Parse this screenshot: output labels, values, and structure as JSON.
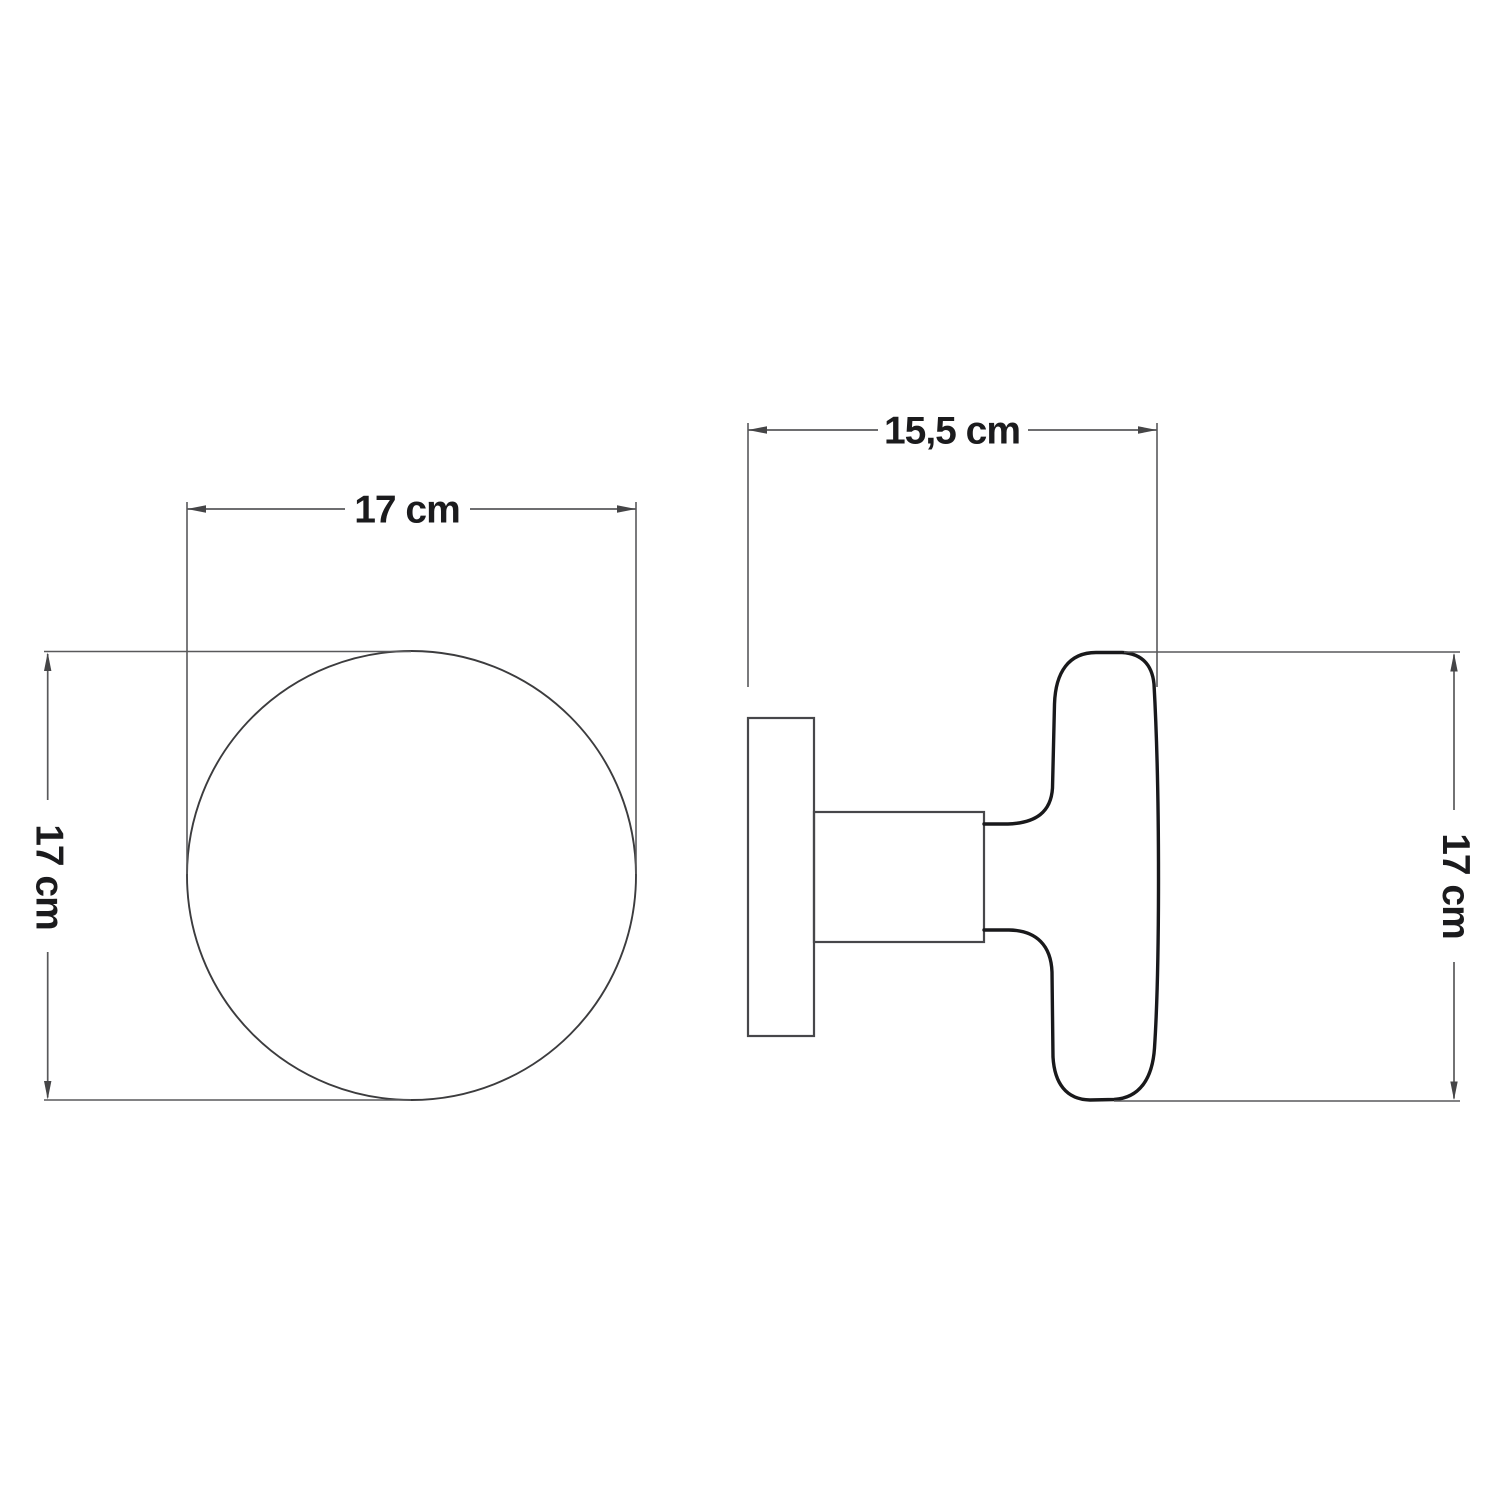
{
  "drawing": {
    "kind": "technical-dimension-drawing",
    "front_view": {
      "width": {
        "label": "17 cm",
        "value_cm": 17
      },
      "height": {
        "label": "17 cm",
        "value_cm": 17
      }
    },
    "side_view": {
      "depth": {
        "label": "15,5 cm",
        "value_cm": 15.5
      },
      "height": {
        "label": "17 cm",
        "value_cm": 17
      }
    },
    "colors": {
      "background": "#ffffff",
      "dimension_lines": "#59595b",
      "object_outline": "#47474a",
      "knob_outline": "#19191b",
      "text": "#1b1b1d"
    }
  }
}
